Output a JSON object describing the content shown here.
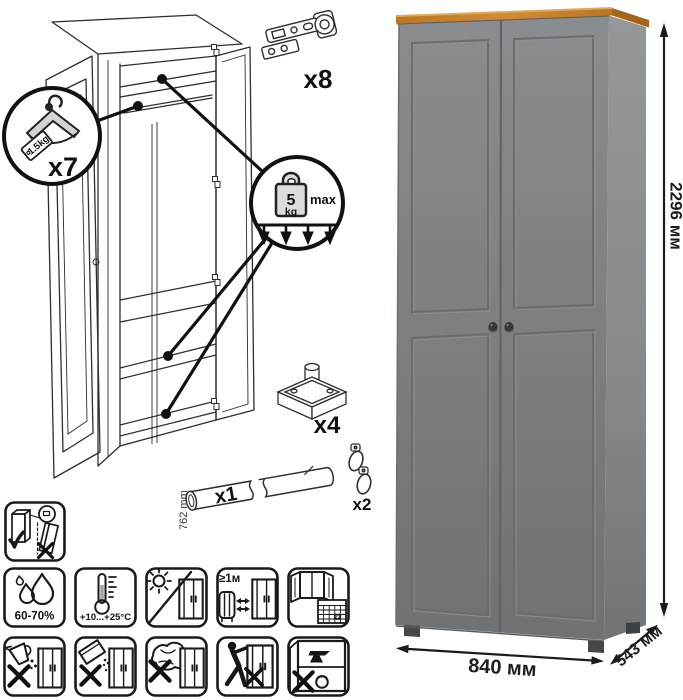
{
  "illustration": {
    "hanger_callout": {
      "tag": "1.5kg",
      "count": "x7"
    },
    "shelf_load_callout": {
      "value": "5",
      "unit": "kg",
      "note": "max"
    },
    "hardware": {
      "hinges_count": "x8",
      "feet_count": "x4",
      "rod_count": "x1",
      "rod_length": "762 mm",
      "hooks_count": "x2"
    }
  },
  "product": {
    "height": "2296 мм",
    "width": "840 мм",
    "depth": "543 мм",
    "colors": {
      "front": "#7b7f81",
      "side": "#8a8e90",
      "top_trim": "#c5812d",
      "knob": "#34383a"
    }
  },
  "care": {
    "humidity": "60-70%",
    "temperature": "+10...+25°C",
    "min_distance": "≥1м",
    "calendar_day": "21"
  }
}
